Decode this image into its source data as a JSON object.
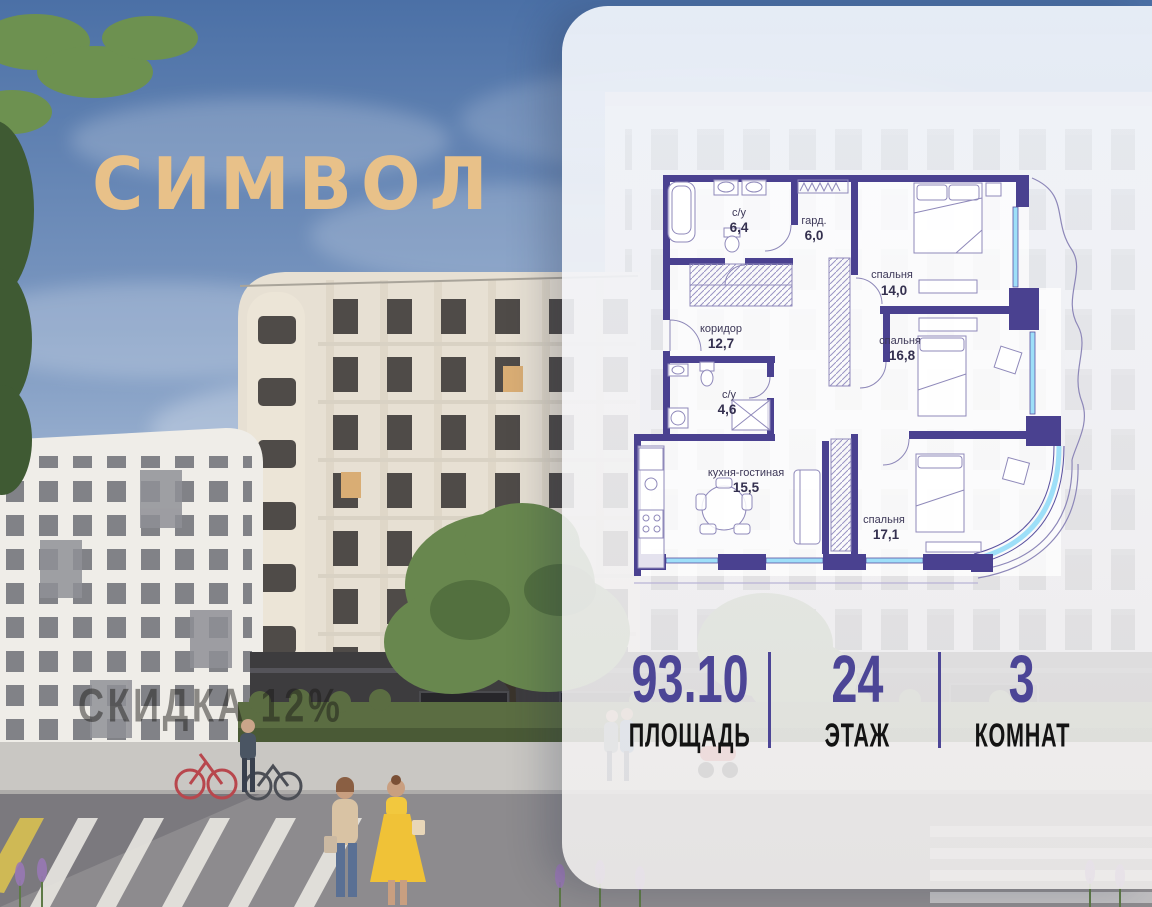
{
  "brand": {
    "name": "СИМВОЛ",
    "color": "#e8c189"
  },
  "photo": {
    "watermark": "СКИДКА 12%"
  },
  "plan": {
    "rooms": [
      {
        "name": "с/у",
        "area": "6,4"
      },
      {
        "name": "гард.",
        "area": "6,0"
      },
      {
        "name": "спальня",
        "area": "14,0"
      },
      {
        "name": "коридор",
        "area": "12,7"
      },
      {
        "name": "спальня",
        "area": "16,8"
      },
      {
        "name": "с/у",
        "area": "4,6"
      },
      {
        "name": "кухня-гостиная",
        "area": "15,5"
      },
      {
        "name": "спальня",
        "area": "17,1"
      }
    ],
    "colors": {
      "wall": "#4a4190",
      "glazing": "#9edff8"
    }
  },
  "stats": {
    "accent": "#4c4596",
    "items": [
      {
        "value": "93.10",
        "label": "ПЛОЩАДЬ"
      },
      {
        "value": "24",
        "label": "ЭТАЖ"
      },
      {
        "value": "3",
        "label": "КОМНАТ"
      }
    ]
  }
}
